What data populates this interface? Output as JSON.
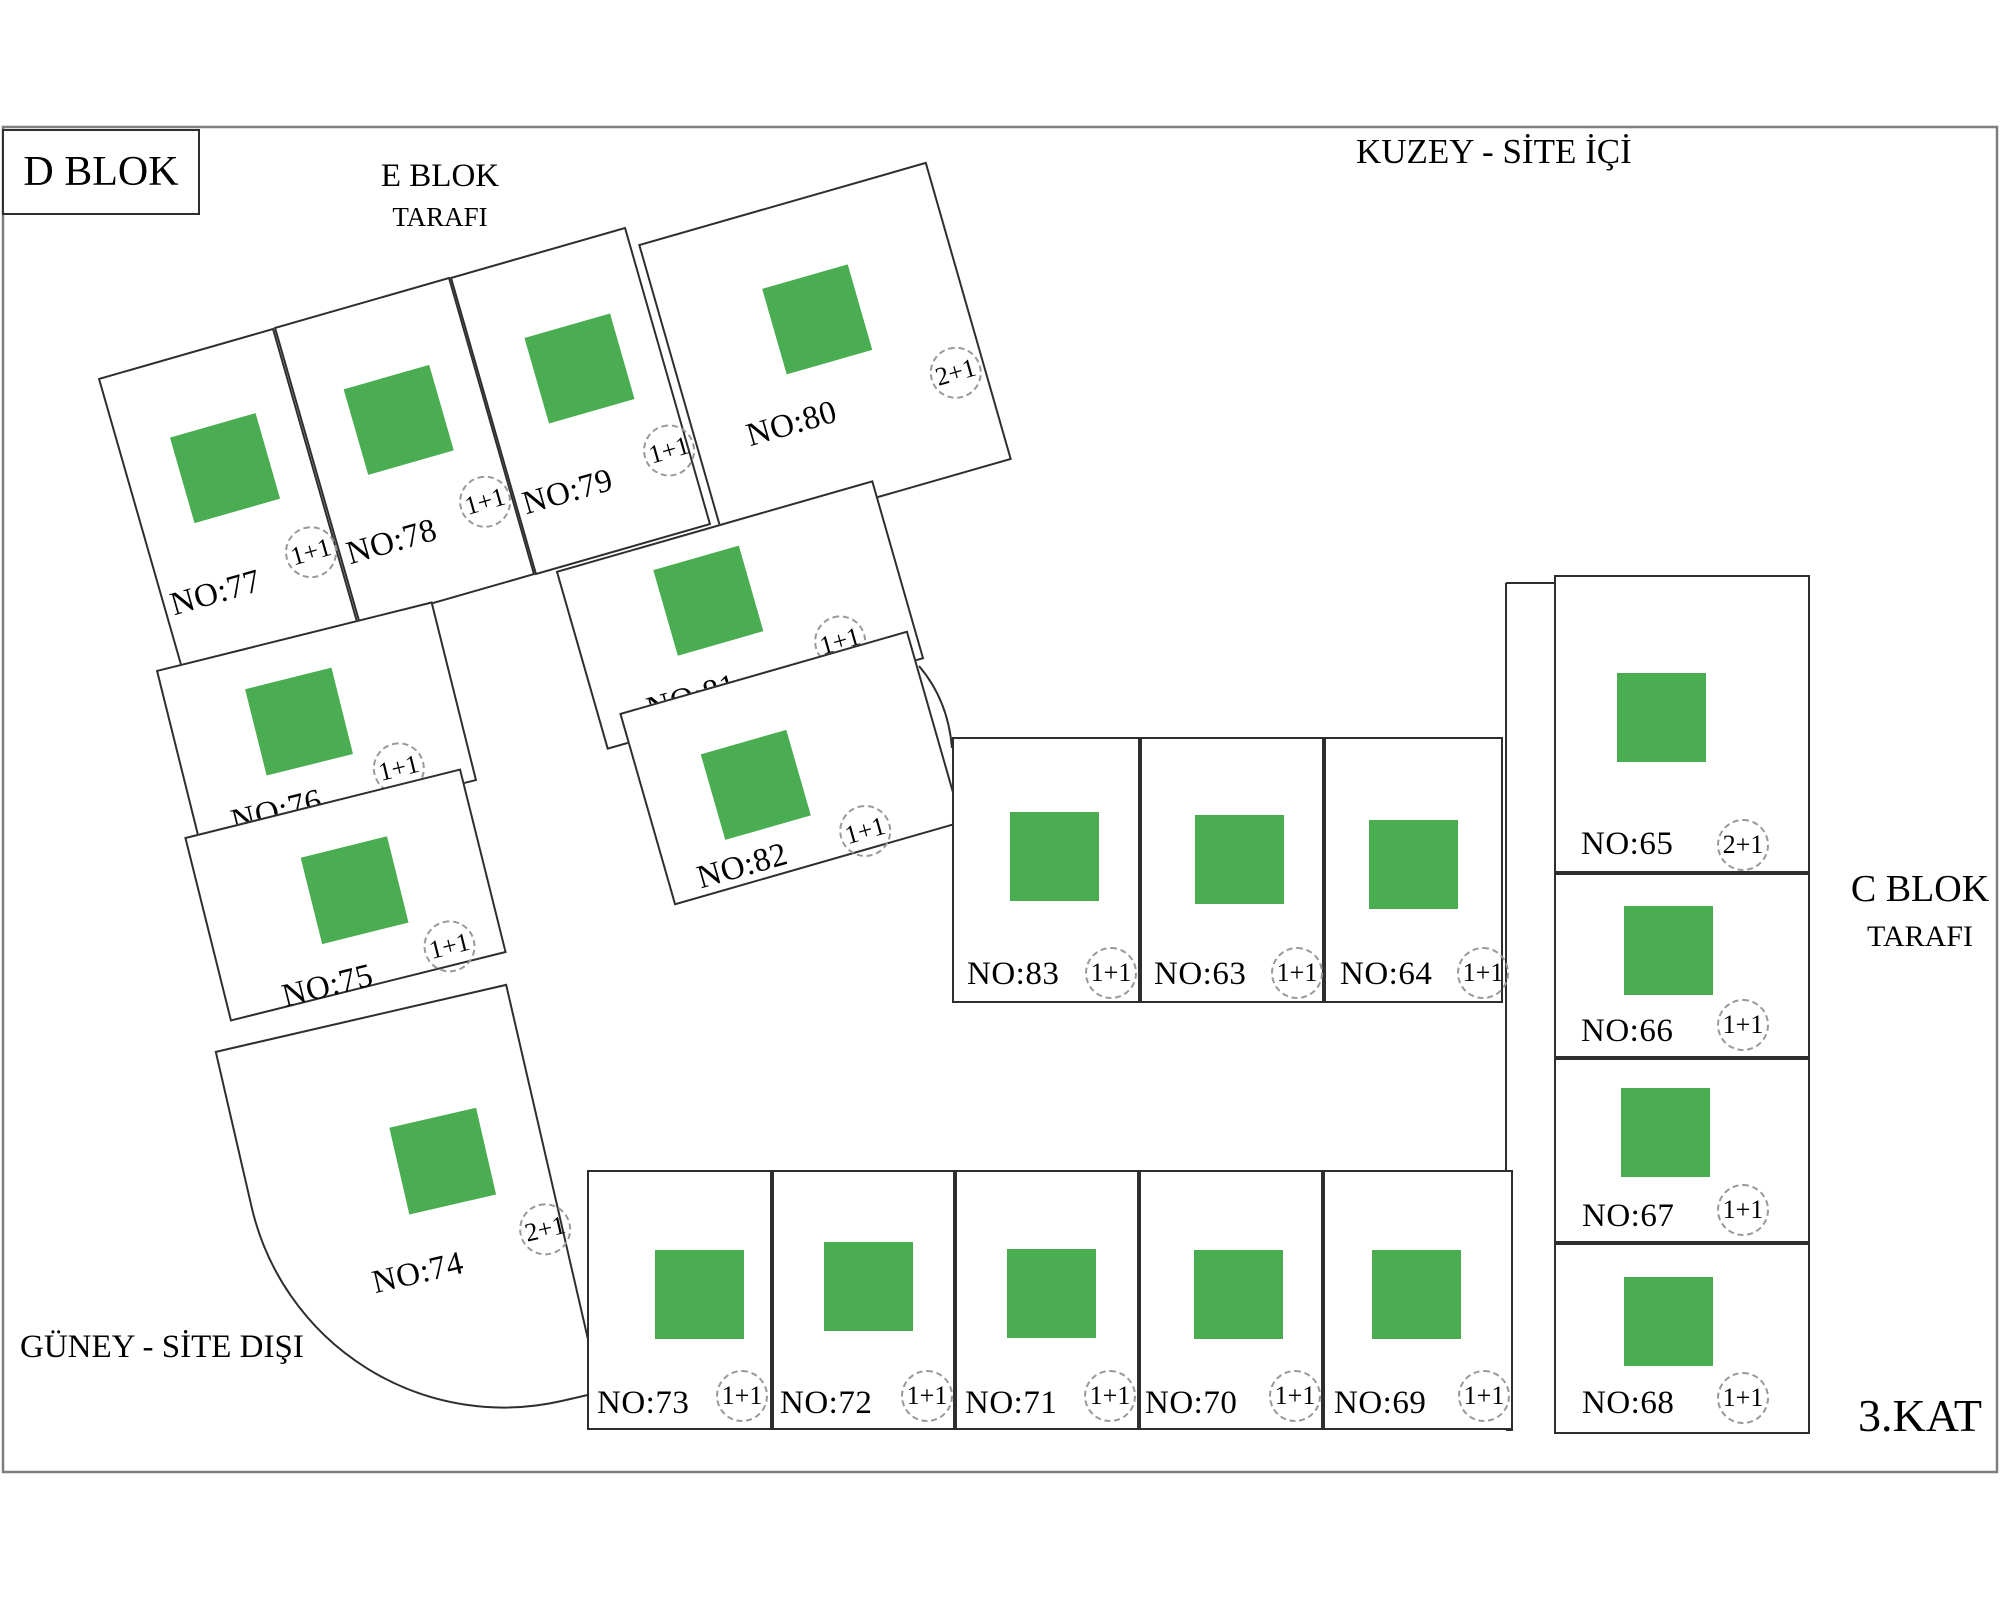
{
  "colors": {
    "background": "#ffffff",
    "outline": "#2e2e2e",
    "frame": "#7e7e7e",
    "square_green": "#4aad51",
    "badge_border": "#999999",
    "text": "#000000"
  },
  "titles": {
    "d_block": "D BLOK",
    "e_block_line1": "E BLOK",
    "e_block_line2": "TARAFI",
    "north": "KUZEY - SİTE İÇİ",
    "c_block_line1": "C BLOK",
    "c_block_line2": "TARAFI",
    "south": "GÜNEY - SİTE DIŞI",
    "floor": "3.KAT"
  },
  "units": [
    {
      "id": "77",
      "label": "NO:77",
      "type": "1+1"
    },
    {
      "id": "78",
      "label": "NO:78",
      "type": "1+1"
    },
    {
      "id": "79",
      "label": "NO:79",
      "type": "1+1"
    },
    {
      "id": "80",
      "label": "NO:80",
      "type": "2+1"
    },
    {
      "id": "81",
      "label": "NO:81",
      "type": "1+1"
    },
    {
      "id": "82",
      "label": "NO:82",
      "type": "1+1"
    },
    {
      "id": "76",
      "label": "NO:76",
      "type": "1+1"
    },
    {
      "id": "75",
      "label": "NO:75",
      "type": "1+1"
    },
    {
      "id": "74",
      "label": "NO:74",
      "type": "2+1"
    },
    {
      "id": "83",
      "label": "NO:83",
      "type": "1+1"
    },
    {
      "id": "63",
      "label": "NO:63",
      "type": "1+1"
    },
    {
      "id": "64",
      "label": "NO:64",
      "type": "1+1"
    },
    {
      "id": "65",
      "label": "NO:65",
      "type": "2+1"
    },
    {
      "id": "66",
      "label": "NO:66",
      "type": "1+1"
    },
    {
      "id": "67",
      "label": "NO:67",
      "type": "1+1"
    },
    {
      "id": "68",
      "label": "NO:68",
      "type": "1+1"
    },
    {
      "id": "73",
      "label": "NO:73",
      "type": "1+1"
    },
    {
      "id": "72",
      "label": "NO:72",
      "type": "1+1"
    },
    {
      "id": "71",
      "label": "NO:71",
      "type": "1+1"
    },
    {
      "id": "70",
      "label": "NO:70",
      "type": "1+1"
    },
    {
      "id": "69",
      "label": "NO:69",
      "type": "1+1"
    }
  ]
}
